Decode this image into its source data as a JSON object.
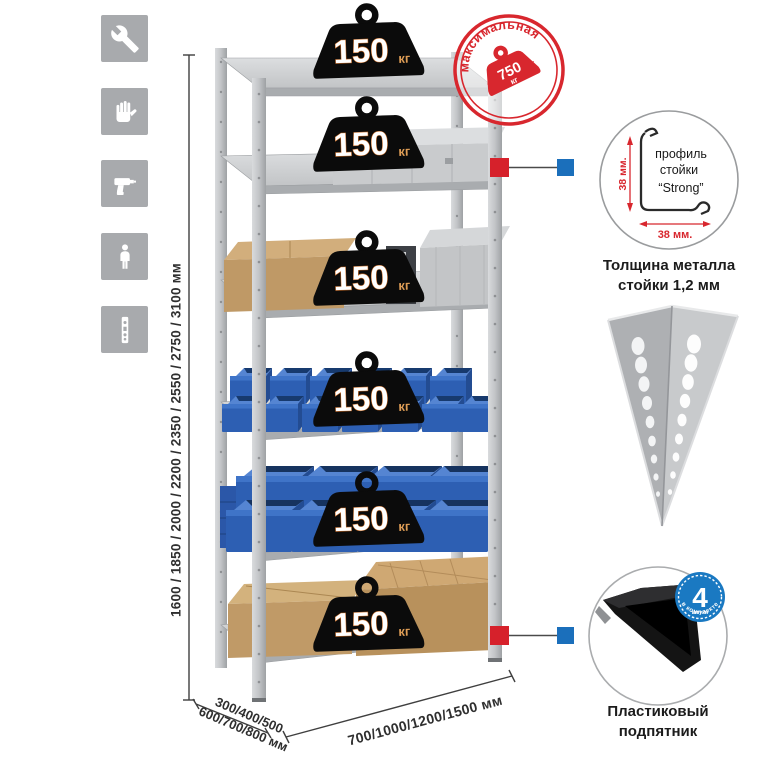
{
  "page": {
    "background": "#ffffff"
  },
  "sidebar": {
    "tile_color": "#a8aaad",
    "icons": [
      {
        "name": "wrench-icon"
      },
      {
        "name": "gloves-icon"
      },
      {
        "name": "drill-icon"
      },
      {
        "name": "person-icon"
      },
      {
        "name": "perforated-post-icon"
      }
    ]
  },
  "dimensions": {
    "height": {
      "label": "1600 / 1850 / 2000 / 2200 / 2350 / 2550 / 2750 / 3100 мм"
    },
    "depth": {
      "line1": "300/400/500",
      "line2": "600/700/800 мм"
    },
    "width": {
      "label": "700/1000/1200/1500 мм"
    }
  },
  "rack": {
    "shelf_count": 6,
    "load_badges": [
      {
        "value": "150",
        "unit": "кг"
      },
      {
        "value": "150",
        "unit": "кг"
      },
      {
        "value": "150",
        "unit": "кг"
      },
      {
        "value": "150",
        "unit": "кг"
      },
      {
        "value": "150",
        "unit": "кг"
      },
      {
        "value": "150",
        "unit": "кг"
      }
    ]
  },
  "max_load_stamp": {
    "arc_top": "максимальная",
    "arc_bottom": "нагрузка",
    "value": "750",
    "unit": "кг",
    "color": "#d8272e"
  },
  "profile_detail": {
    "label_line1": "профиль",
    "label_line2": "стойки",
    "label_line3": "“Strong”",
    "dim_vertical": "38 мм.",
    "dim_horizontal": "38 мм.",
    "caption_line1": "Толщина металла",
    "caption_line2": "стойки 1,2 мм"
  },
  "foot_detail": {
    "badge_value": "4",
    "badge_small_text": "штуки",
    "badge_arc_text": "в комплекте",
    "badge_color": "#1a79c2",
    "caption_line1": "Пластиковый",
    "caption_line2": "подпятник"
  },
  "connectors": {
    "red": "#d6212b",
    "blue": "#1b6fbb"
  },
  "colors": {
    "bin_blue": "#2d5fb3",
    "metal": "#c9cbcd",
    "cardboard": "#c09a67",
    "badge_black": "#0b0b0b",
    "badge_unit_orange": "#dd9c55"
  }
}
